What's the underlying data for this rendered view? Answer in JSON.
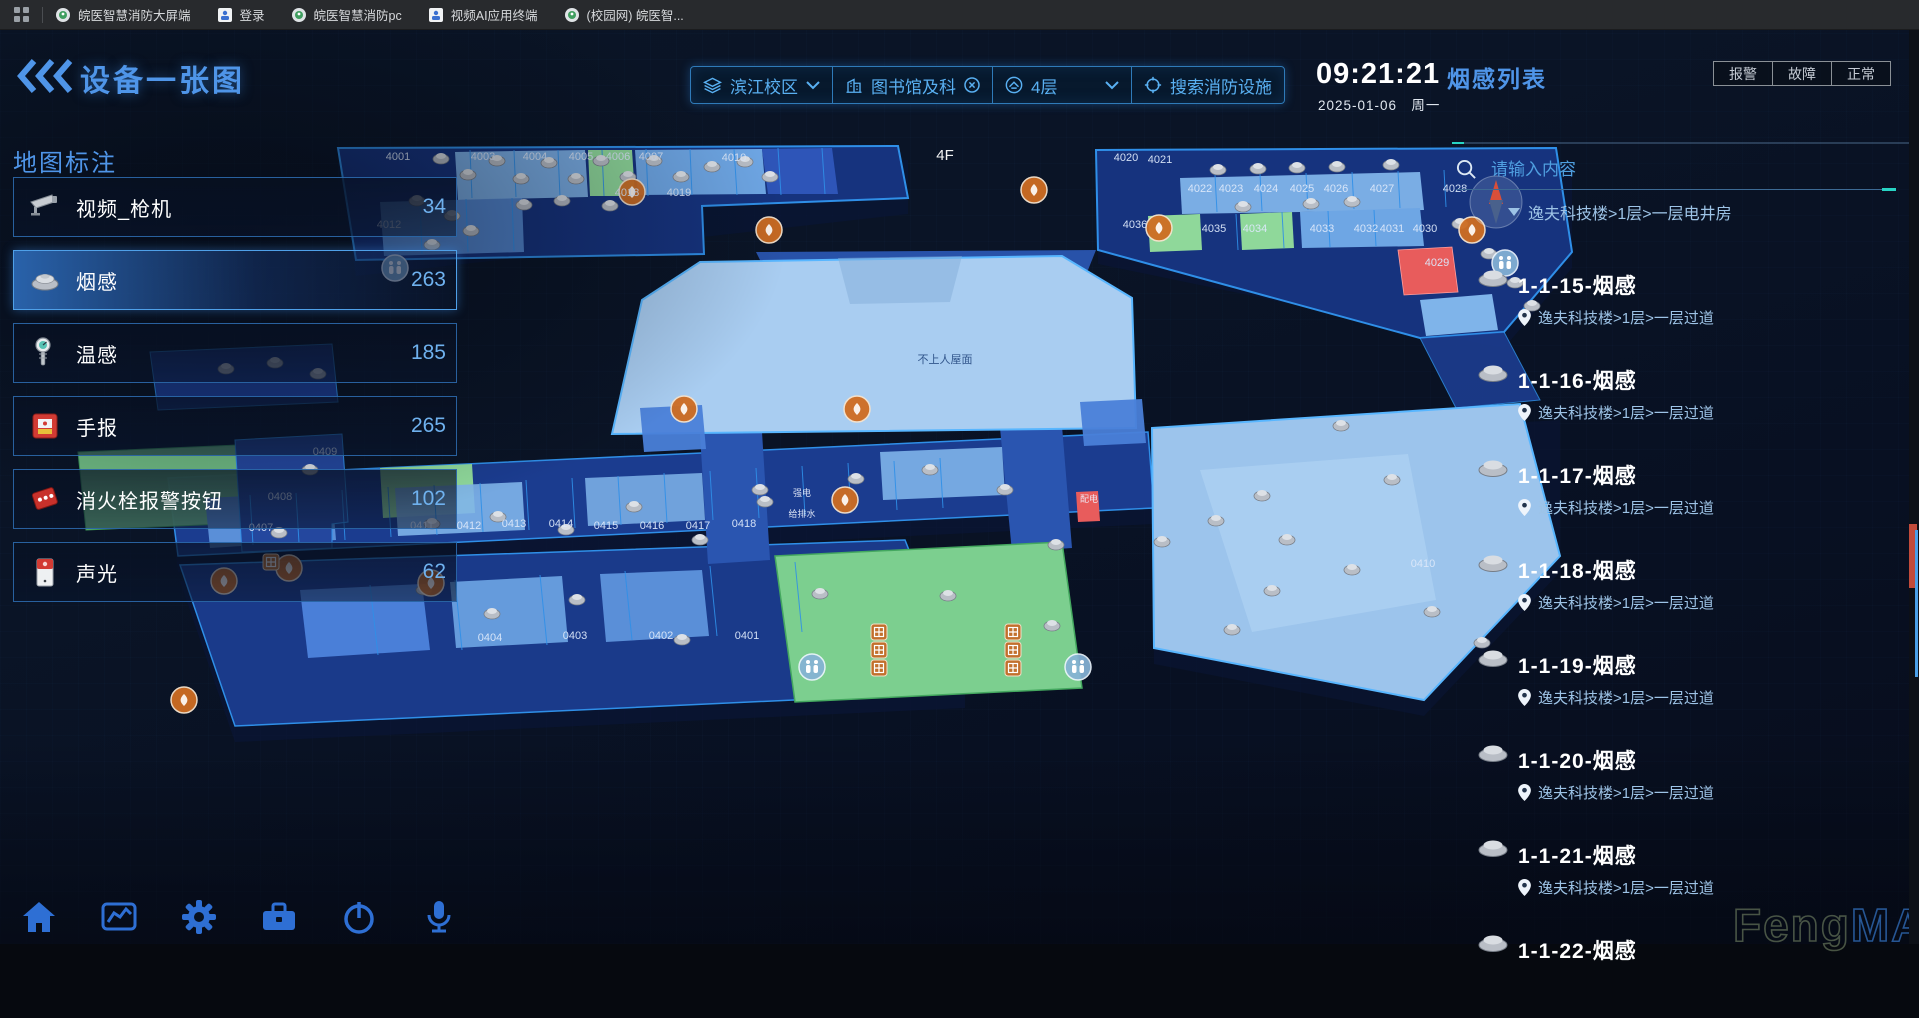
{
  "browser": {
    "bookmarks": [
      {
        "label": "皖医智慧消防大屏端",
        "style": "badge"
      },
      {
        "label": "登录",
        "style": "app"
      },
      {
        "label": "皖医智慧消防pc",
        "style": "badge"
      },
      {
        "label": "视频AI应用终端",
        "style": "app"
      },
      {
        "label": "(校园网) 皖医智...",
        "style": "badge"
      }
    ]
  },
  "header": {
    "title": "设备一张图"
  },
  "filters": {
    "campus": "滨江校区",
    "building": "图书馆及科",
    "floor": "4层",
    "search": "搜索消防设施"
  },
  "clock": {
    "time": "09:21:21",
    "date": "2025-01-06",
    "weekday": "周一"
  },
  "panel": {
    "title": "烟感列表",
    "status_buttons": [
      "报警",
      "故障",
      "正常"
    ],
    "search_placeholder": "请输入内容",
    "partial_location": "逸夫科技楼>1层>一层电井房"
  },
  "sidebar": {
    "title": "地图标注",
    "items": [
      {
        "label": "视频_枪机",
        "count": "34",
        "icon": "camera"
      },
      {
        "label": "烟感",
        "count": "263",
        "icon": "smoke-detector",
        "selected": true
      },
      {
        "label": "温感",
        "count": "185",
        "icon": "thermometer"
      },
      {
        "label": "手报",
        "count": "265",
        "icon": "manual-call-point"
      },
      {
        "label": "消火栓报警按钮",
        "count": "102",
        "icon": "hydrant-button"
      },
      {
        "label": "声光",
        "count": "62",
        "icon": "sounder"
      }
    ]
  },
  "list": {
    "items": [
      {
        "title": "1-1-15-烟感",
        "location": "逸夫科技楼>1层>一层过道"
      },
      {
        "title": "1-1-16-烟感",
        "location": "逸夫科技楼>1层>一层过道"
      },
      {
        "title": "1-1-17-烟感",
        "location": "逸夫科技楼>1层>一层过道"
      },
      {
        "title": "1-1-18-烟感",
        "location": "逸夫科技楼>1层>一层过道"
      },
      {
        "title": "1-1-19-烟感",
        "location": "逸夫科技楼>1层>一层过道"
      },
      {
        "title": "1-1-20-烟感",
        "location": "逸夫科技楼>1层>一层过道"
      },
      {
        "title": "1-1-21-烟感",
        "location": "逸夫科技楼>1层>一层过道"
      },
      {
        "title": "1-1-22-烟感",
        "location": ""
      }
    ]
  },
  "dock": {
    "icons": [
      "home",
      "analytics",
      "settings",
      "toolbox",
      "power",
      "microphone"
    ]
  },
  "watermark": {
    "left": "Feng",
    "right": "MAP"
  },
  "map": {
    "shapes": [
      {
        "pts": "338,164 908,160 908,214 356,276",
        "fill": "#0a1636",
        "op": 0.75
      },
      {
        "pts": "1096,166 1572,164 1572,268 1504,348 1098,264",
        "fill": "#0a1636",
        "op": 0.7
      },
      {
        "pts": "168,494 1154,448 1154,524 178,572",
        "fill": "#0a1636",
        "op": 0.7
      },
      {
        "pts": "180,581 965,556 965,708 235,742",
        "fill": "#0a1636",
        "op": 0.7
      },
      {
        "pts": "1152,444 1560,420 1560,572 1424,716 1154,664",
        "fill": "#0a1636",
        "op": 0.6
      },
      {
        "pts": "338,148 898,146 908,198 702,206 704,254 356,260",
        "fill": "#16337e",
        "stroke": "#2f8fe8",
        "sw": 2
      },
      {
        "pts": "1096,150 1556,148 1572,252 1504,332 1420,338 1098,250",
        "fill": "#16337e",
        "stroke": "#2f8fe8",
        "sw": 2
      },
      {
        "pts": "1420,338 1504,332 1540,400 1456,408",
        "fill": "#1d3f96",
        "stroke": "#2f8fe8",
        "sw": 1,
        "op": 0.85
      },
      {
        "pts": "168,478 1148,432 1154,508 178,556",
        "fill": "#1b3c8f",
        "stroke": "#2f8fe8",
        "sw": 1.5
      },
      {
        "pts": "180,565 905,540 965,692 235,726",
        "fill": "#1a3a8a",
        "stroke": "#2f8fe8",
        "sw": 1.5
      },
      {
        "pts": "150,352 332,344 338,402 158,410",
        "fill": "#1d3f96",
        "stroke": "#2f8fe8",
        "sw": 1,
        "op": 0.9
      },
      {
        "pts": "78,452 262,444 270,522 86,530",
        "fill": "#7ccf8f",
        "stroke": "#44a85f",
        "sw": 1,
        "op": 0.9
      },
      {
        "pts": "1152,428 1520,404 1560,556 1424,700 1154,648",
        "fill": "#9cc4ec",
        "stroke": "#58b6ff",
        "sw": 2
      },
      {
        "pts": "1200,470 1408,454 1436,600 1252,632",
        "fill": "#b5d7f5",
        "op": 0.55
      },
      {
        "pts": "756,252 1096,250 1088,270 766,272",
        "fill": "#2a55b0",
        "op": 0.95
      },
      {
        "pts": "700,434 762,432 770,560 708,564",
        "fill": "#2a55b0"
      },
      {
        "pts": "1000,428 1062,426 1072,548 1012,552",
        "fill": "#2a55b0"
      },
      {
        "pts": "700,262 1062,256 1132,298 1136,428 612,434 642,300",
        "fill": "#a9cdf1",
        "stroke": "#58b6ff",
        "sw": 2
      },
      {
        "pts": "838,258 962,256 950,302 850,304",
        "fill": "#84add9",
        "op": 0.5
      },
      {
        "pts": "775,556 1062,542 1082,688 795,702",
        "fill": "#7ccf8f",
        "stroke": "#44a85f",
        "sw": 1.5
      },
      {
        "pts": "455,152 585,150 588,197 458,200",
        "fill": "#7fb4ea",
        "op": 0.95
      },
      {
        "pts": "588,150 632,150 635,196 590,196",
        "fill": "#8fd89a"
      },
      {
        "pts": "635,150 762,149 766,194 638,195",
        "fill": "#6ea6e4"
      },
      {
        "pts": "762,149 832,148 838,194 768,194",
        "fill": "#2e55b8"
      },
      {
        "pts": "380,202 522,198 524,252 384,256",
        "fill": "#5a8fd8",
        "op": 0.9
      },
      {
        "pts": "1180,178 1420,172 1424,210 1182,214",
        "fill": "#7fb4ea",
        "op": 0.95
      },
      {
        "pts": "1148,216 1200,214 1202,250 1150,252",
        "fill": "#8fd89a"
      },
      {
        "pts": "1240,214 1292,212 1294,248 1242,250",
        "fill": "#8fd89a"
      },
      {
        "pts": "1300,212 1420,208 1424,246 1302,248",
        "fill": "#6ea6e4"
      },
      {
        "pts": "1398,250 1452,247 1458,292 1404,295",
        "fill": "#e85c5c",
        "stroke": "#ff9f9f",
        "sw": 0.8
      },
      {
        "pts": "1420,300 1492,294 1498,330 1426,336",
        "fill": "#7fb4ea"
      },
      {
        "pts": "205,498 332,492 336,540 210,548",
        "fill": "#5a8fd8"
      },
      {
        "pts": "380,468 472,464 475,513 383,518",
        "fill": "#8fd89a"
      },
      {
        "pts": "395,488 522,482 525,530 398,536",
        "fill": "#7fb4ea",
        "op": 0.9
      },
      {
        "pts": "585,478 702,473 705,520 588,526",
        "fill": "#7fb4ea",
        "op": 0.85
      },
      {
        "pts": "880,452 1002,447 1005,495 883,500",
        "fill": "#7fb4ea",
        "op": 0.9
      },
      {
        "pts": "235,440 342,434 348,522 332,524 332,548 242,552",
        "fill": "#24479e",
        "stroke": "#2f8fe8",
        "sw": 1
      },
      {
        "pts": "300,590 422,584 430,650 308,658",
        "fill": "#4a7fd8"
      },
      {
        "pts": "450,582 562,576 568,642 456,648",
        "fill": "#6ea6e4",
        "op": 0.9
      },
      {
        "pts": "600,574 702,570 709,636 606,642",
        "fill": "#5a8fd8"
      },
      {
        "pts": "640,408 702,405 706,449 644,452",
        "fill": "#4a7fd8",
        "op": 0.95
      },
      {
        "pts": "1080,402 1142,399 1146,443 1084,446",
        "fill": "#4a7fd8",
        "op": 0.95
      },
      {
        "pts": "1076,492 1098,491 1100,521 1078,522",
        "fill": "#e85c5c"
      }
    ],
    "lines": [
      {
        "d": "M470,150 L472,198 M514,150 L516,197 M558,150 L560,197 M602,150 L604,196 M646,149 L648,196 M690,149 L692,195 M734,149 L737,195 M778,148 L781,195 M822,148 L825,194",
        "c": "#2f8fe8",
        "w": 1
      },
      {
        "d": "M420,200 L422,254 M466,199 L468,252 M512,198 L514,251",
        "c": "#2f8fe8",
        "w": 1
      },
      {
        "d": "M1215,175 L1217,212 M1260,174 L1262,211 M1306,173 L1308,210 M1352,172 L1354,209 M1398,171 L1400,208 M1444,170 L1446,207",
        "c": "#2f8fe8",
        "w": 1
      },
      {
        "d": "M1236,214 L1238,250 M1282,212 L1284,248 M1328,211 L1330,247 M1374,210 L1376,246",
        "c": "#2f8fe8",
        "w": 1
      },
      {
        "d": "M250,495 L253,545 M296,493 L299,543 M342,490 L345,540 M388,487 L391,537 M434,485 L437,535 M480,483 L483,532 M526,480 L529,530 M572,478 L575,528 M618,476 L621,525 M664,473 L667,523 M710,471 L713,520 M756,468 L759,518 M802,466 L805,515 M848,463 L851,513 M894,461 L897,510 M940,458 L943,508",
        "c": "#2f8fe8",
        "w": 1
      },
      {
        "d": "M370,585 L378,655 M455,580 L462,650 M540,575 L547,645 M625,571 L632,640 M710,566 L717,636 M795,562 L802,632",
        "c": "#2f8fe8",
        "w": 1
      }
    ],
    "room_labels": [
      {
        "t": "4F",
        "x": 945,
        "y": 160,
        "s": 15,
        "c": "#ffffff"
      },
      {
        "t": "不上人屋面",
        "x": 945,
        "y": 363,
        "s": 11,
        "c": "#2b4f86"
      },
      {
        "t": "4001",
        "x": 398,
        "y": 160
      },
      {
        "t": "4003",
        "x": 483,
        "y": 160
      },
      {
        "t": "4004",
        "x": 535,
        "y": 160
      },
      {
        "t": "4005",
        "x": 581,
        "y": 160
      },
      {
        "t": "4006",
        "x": 618,
        "y": 160
      },
      {
        "t": "4007",
        "x": 651,
        "y": 160
      },
      {
        "t": "4010",
        "x": 734,
        "y": 161
      },
      {
        "t": "4012",
        "x": 389,
        "y": 228
      },
      {
        "t": "4018",
        "x": 627,
        "y": 196
      },
      {
        "t": "4019",
        "x": 679,
        "y": 196
      },
      {
        "t": "4020",
        "x": 1126,
        "y": 161
      },
      {
        "t": "4021",
        "x": 1160,
        "y": 163
      },
      {
        "t": "4022",
        "x": 1200,
        "y": 192
      },
      {
        "t": "4023",
        "x": 1231,
        "y": 192
      },
      {
        "t": "4024",
        "x": 1266,
        "y": 192
      },
      {
        "t": "4025",
        "x": 1302,
        "y": 192
      },
      {
        "t": "4026",
        "x": 1336,
        "y": 192
      },
      {
        "t": "4027",
        "x": 1382,
        "y": 192
      },
      {
        "t": "4028",
        "x": 1455,
        "y": 192
      },
      {
        "t": "4036",
        "x": 1135,
        "y": 228
      },
      {
        "t": "4035",
        "x": 1214,
        "y": 232
      },
      {
        "t": "4034",
        "x": 1255,
        "y": 232
      },
      {
        "t": "4033",
        "x": 1322,
        "y": 232
      },
      {
        "t": "4032",
        "x": 1366,
        "y": 232
      },
      {
        "t": "4031",
        "x": 1392,
        "y": 232
      },
      {
        "t": "4030",
        "x": 1425,
        "y": 232
      },
      {
        "t": "4029",
        "x": 1437,
        "y": 266
      },
      {
        "t": "0409",
        "x": 325,
        "y": 455
      },
      {
        "t": "0408",
        "x": 280,
        "y": 500
      },
      {
        "t": "0407",
        "x": 261,
        "y": 531
      },
      {
        "t": "0411",
        "x": 422,
        "y": 529
      },
      {
        "t": "0412",
        "x": 469,
        "y": 529
      },
      {
        "t": "0413",
        "x": 514,
        "y": 527
      },
      {
        "t": "0414",
        "x": 561,
        "y": 527
      },
      {
        "t": "0415",
        "x": 606,
        "y": 529
      },
      {
        "t": "0416",
        "x": 652,
        "y": 529
      },
      {
        "t": "0417",
        "x": 698,
        "y": 529
      },
      {
        "t": "0418",
        "x": 744,
        "y": 527
      },
      {
        "t": "0404",
        "x": 490,
        "y": 641
      },
      {
        "t": "0403",
        "x": 575,
        "y": 639
      },
      {
        "t": "0402",
        "x": 661,
        "y": 639
      },
      {
        "t": "0401",
        "x": 747,
        "y": 639
      },
      {
        "t": "0410",
        "x": 1423,
        "y": 567
      }
    ],
    "utility_labels": [
      {
        "t": "强电",
        "x": 802,
        "y": 496
      },
      {
        "t": "给排水",
        "x": 802,
        "y": 517
      },
      {
        "t": "配电",
        "x": 1089,
        "y": 502
      }
    ],
    "detectors": [
      [
        441,
        157
      ],
      [
        468,
        173
      ],
      [
        497,
        159
      ],
      [
        521,
        177
      ],
      [
        549,
        161
      ],
      [
        576,
        177
      ],
      [
        601,
        159
      ],
      [
        628,
        175
      ],
      [
        654,
        159
      ],
      [
        681,
        175
      ],
      [
        712,
        165
      ],
      [
        745,
        160
      ],
      [
        770,
        175
      ],
      [
        524,
        203
      ],
      [
        562,
        199
      ],
      [
        610,
        204
      ],
      [
        452,
        214
      ],
      [
        417,
        199
      ],
      [
        471,
        229
      ],
      [
        432,
        243
      ],
      [
        1218,
        168
      ],
      [
        1258,
        167
      ],
      [
        1297,
        166
      ],
      [
        1337,
        165
      ],
      [
        1391,
        163
      ],
      [
        1243,
        205
      ],
      [
        1311,
        202
      ],
      [
        1352,
        200
      ],
      [
        1460,
        222
      ],
      [
        1489,
        252
      ],
      [
        1515,
        281
      ],
      [
        1532,
        304
      ],
      [
        226,
        367
      ],
      [
        275,
        361
      ],
      [
        318,
        372
      ],
      [
        310,
        468
      ],
      [
        279,
        531
      ],
      [
        432,
        522
      ],
      [
        498,
        515
      ],
      [
        566,
        528
      ],
      [
        634,
        505
      ],
      [
        700,
        538
      ],
      [
        765,
        500
      ],
      [
        856,
        477
      ],
      [
        930,
        468
      ],
      [
        1005,
        488
      ],
      [
        1056,
        543
      ],
      [
        948,
        594
      ],
      [
        1162,
        540
      ],
      [
        1216,
        519
      ],
      [
        1262,
        494
      ],
      [
        1287,
        538
      ],
      [
        1341,
        424
      ],
      [
        1392,
        478
      ],
      [
        1432,
        610
      ],
      [
        1482,
        641
      ],
      [
        1272,
        589
      ],
      [
        1352,
        568
      ],
      [
        1232,
        628
      ],
      [
        1052,
        624
      ],
      [
        424,
        588
      ],
      [
        492,
        612
      ],
      [
        577,
        598
      ],
      [
        682,
        638
      ],
      [
        820,
        592
      ],
      [
        760,
        488
      ]
    ],
    "markers": [
      {
        "t": "orange",
        "x": 632,
        "y": 192
      },
      {
        "t": "orange",
        "x": 769,
        "y": 230
      },
      {
        "t": "orange",
        "x": 1034,
        "y": 190
      },
      {
        "t": "orange",
        "x": 1159,
        "y": 228
      },
      {
        "t": "orange",
        "x": 1472,
        "y": 230
      },
      {
        "t": "orange",
        "x": 845,
        "y": 500
      },
      {
        "t": "orange",
        "x": 684,
        "y": 409
      },
      {
        "t": "orange",
        "x": 857,
        "y": 409
      },
      {
        "t": "orange",
        "x": 224,
        "y": 581
      },
      {
        "t": "orange",
        "x": 289,
        "y": 568
      },
      {
        "t": "orange",
        "x": 431,
        "y": 583
      },
      {
        "t": "orange",
        "x": 184,
        "y": 700
      },
      {
        "t": "wc",
        "x": 395,
        "y": 268
      },
      {
        "t": "wc",
        "x": 1505,
        "y": 263
      },
      {
        "t": "wc",
        "x": 812,
        "y": 667
      },
      {
        "t": "wc",
        "x": 1078,
        "y": 667
      },
      {
        "t": "lift",
        "x": 879,
        "y": 632
      },
      {
        "t": "lift",
        "x": 879,
        "y": 650
      },
      {
        "t": "lift",
        "x": 879,
        "y": 668
      },
      {
        "t": "lift",
        "x": 1013,
        "y": 632
      },
      {
        "t": "lift",
        "x": 1013,
        "y": 650
      },
      {
        "t": "lift",
        "x": 1013,
        "y": 668
      },
      {
        "t": "lift",
        "x": 271,
        "y": 562
      }
    ],
    "compass": {
      "x": 1496,
      "y": 202,
      "r": 26
    }
  }
}
